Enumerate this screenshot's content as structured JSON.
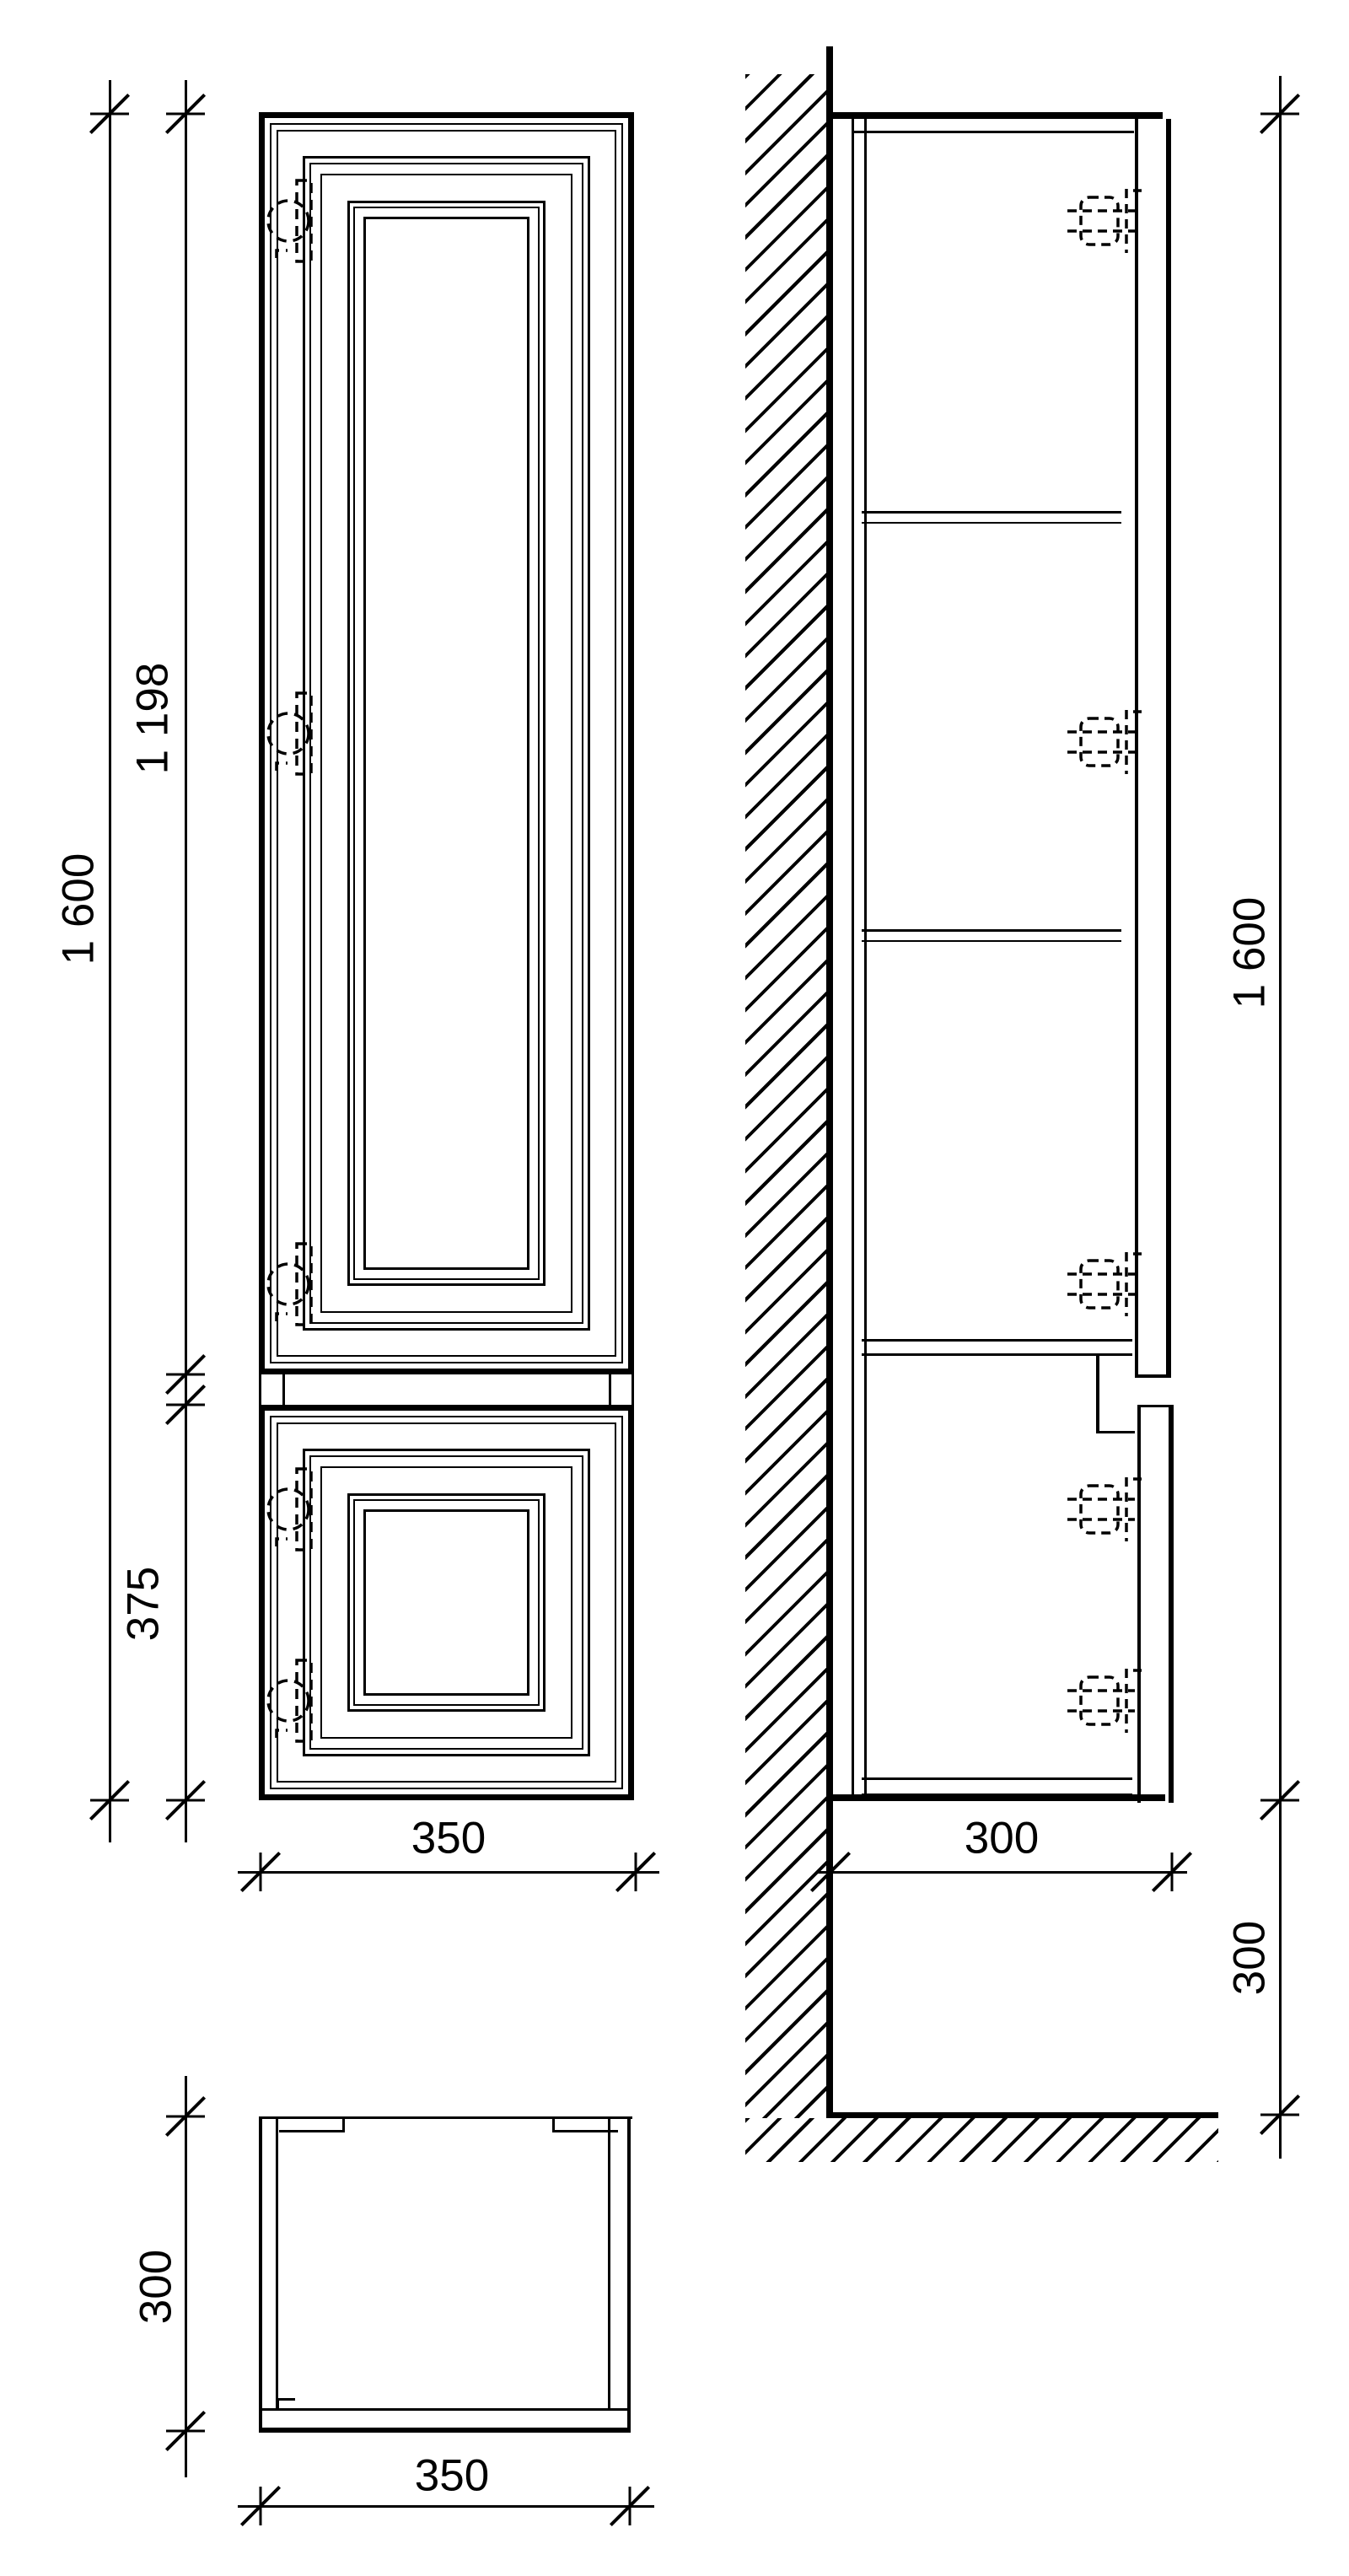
{
  "drawing": {
    "type": "cabinet-technical-drawing",
    "colors": {
      "ink": "#000000",
      "paper": "#ffffff"
    },
    "views": {
      "front": "front-view",
      "side": "side-view-wall-mounted",
      "plan": "plan-view"
    },
    "dims": {
      "front_total_height": "1 600",
      "front_upper_door_height": "1 198",
      "front_lower_door_height": "375",
      "front_width": "350",
      "side_total_height": "1 600",
      "side_depth": "300",
      "side_floor_offset": "300",
      "plan_depth": "300",
      "plan_width": "350"
    }
  }
}
